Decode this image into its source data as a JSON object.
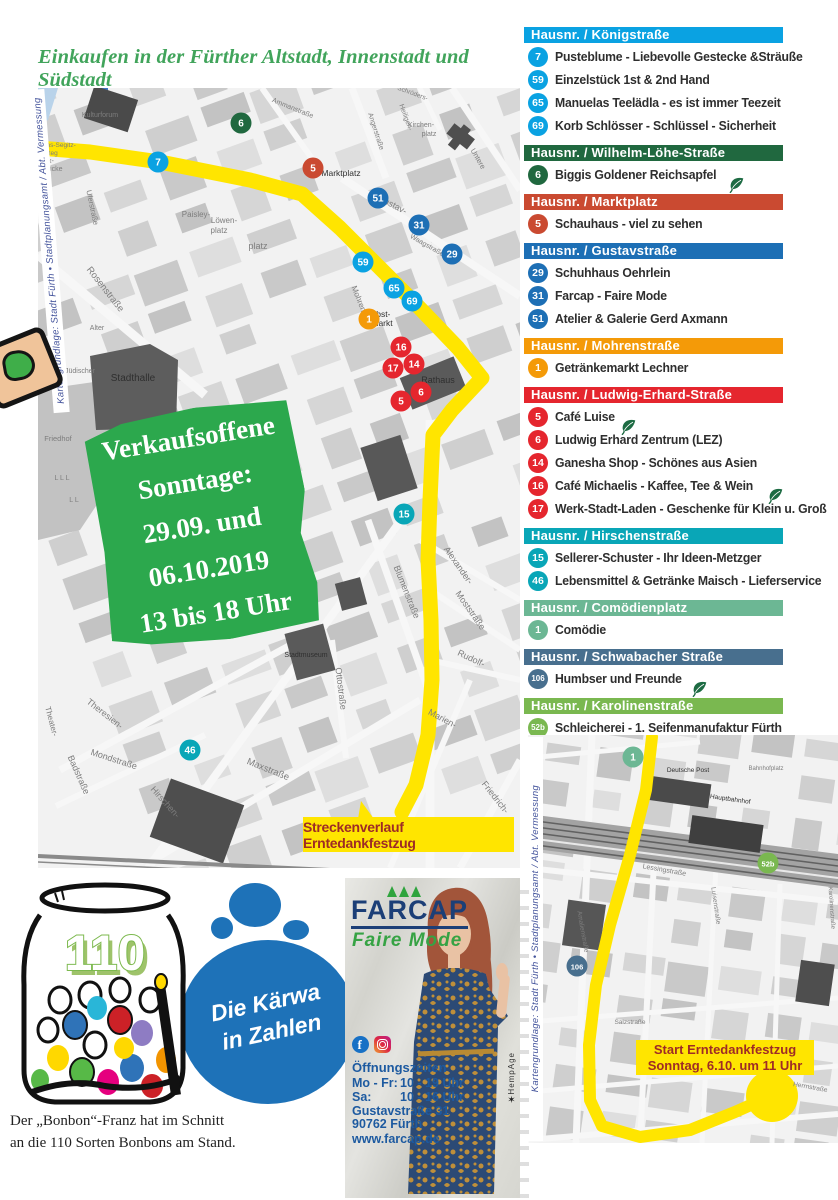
{
  "page": {
    "title": "Einkaufen in der Fürther Altstadt, Innenstadt und Südstadt"
  },
  "colors": {
    "title_green": "#41a45b",
    "promo_green": "#2ca84d",
    "route_yellow": "#ffe500",
    "route_label_red": "#9e2b26",
    "farcap_navy": "#1c3f77",
    "farcap_green": "#36a344",
    "farcap_blue": "#1d5aa0",
    "blob_blue": "#1e72b8",
    "leaf_green": "#1d6b43"
  },
  "sidebar": {
    "sections": [
      {
        "header": "Hausnr. / Königstraße",
        "color": "#0aa2e2",
        "items": [
          {
            "num": "7",
            "label": "Pusteblume - Liebevolle Gestecke &Sträuße",
            "leaf": false
          },
          {
            "num": "59",
            "label": "Einzelstück 1st & 2nd Hand",
            "leaf": false
          },
          {
            "num": "65",
            "label": "Manuelas Teelädla - es ist immer Teezeit",
            "leaf": false
          },
          {
            "num": "69",
            "label": "Korb Schlösser - Schlüssel - Sicherheit",
            "leaf": false
          }
        ]
      },
      {
        "header": "Hausnr. / Wilhelm-Löhe-Straße",
        "color": "#20683f",
        "items": [
          {
            "num": "6",
            "label": "Biggis Goldener Reichsapfel",
            "leaf": true
          }
        ]
      },
      {
        "header": "Hausnr. / Marktplatz",
        "color": "#ca4a31",
        "items": [
          {
            "num": "5",
            "label": "Schauhaus - viel zu sehen",
            "leaf": false
          }
        ]
      },
      {
        "header": "Hausnr. / Gustavstraße",
        "color": "#1d6fb5",
        "items": [
          {
            "num": "29",
            "label": "Schuhhaus Oehrlein",
            "leaf": false
          },
          {
            "num": "31",
            "label": "Farcap - Faire Mode",
            "leaf": false
          },
          {
            "num": "51",
            "label": "Atelier & Galerie Gerd Axmann",
            "leaf": false
          }
        ]
      },
      {
        "header": "Hausnr. / Mohrenstraße",
        "color": "#f49a08",
        "items": [
          {
            "num": "1",
            "label": "Getränkemarkt Lechner",
            "leaf": false
          }
        ]
      },
      {
        "header": "Hausnr. / Ludwig-Erhard-Straße",
        "color": "#e5262e",
        "items": [
          {
            "num": "5",
            "label": "Café Luise",
            "leaf": true
          },
          {
            "num": "6",
            "label": "Ludwig Erhard Zentrum (LEZ)",
            "leaf": false
          },
          {
            "num": "14",
            "label": "Ganesha Shop - Schönes aus Asien",
            "leaf": false
          },
          {
            "num": "16",
            "label": "Café Michaelis - Kaffee, Tee & Wein",
            "leaf": true
          },
          {
            "num": "17",
            "label": "Werk-Stadt-Laden - Geschenke für Klein u. Groß",
            "leaf": false
          }
        ]
      },
      {
        "header": "Hausnr. / Hirschenstraße",
        "color": "#09a6b7",
        "items": [
          {
            "num": "15",
            "label": "Sellerer-Schuster - Ihr Ideen-Metzger",
            "leaf": false
          },
          {
            "num": "46",
            "label": "Lebensmittel & Getränke Maisch - Lieferservice",
            "leaf": false
          }
        ]
      },
      {
        "header": "Hausnr. / Comödienplatz",
        "color": "#6cb794",
        "items": [
          {
            "num": "1",
            "label": "Comödie",
            "leaf": false
          }
        ]
      },
      {
        "header": "Hausnr. / Schwabacher Straße",
        "color": "#486f8e",
        "items": [
          {
            "num": "106",
            "label": "Humbser und Freunde",
            "leaf": true
          }
        ]
      },
      {
        "header": "Hausnr. / Karolinenstraße",
        "color": "#7ab850",
        "items": [
          {
            "num": "52b",
            "label": "Schleicherei - 1. Seifenmanufaktur Fürth",
            "leaf": false
          }
        ]
      }
    ]
  },
  "map_main": {
    "credit": "Kartengrundlage: Stadt Fürth • Stadtplanungsamt / Abt. Vermessung",
    "promo_lines": [
      "Verkaufsoffene",
      "Sonntage:",
      "29.09. und",
      "06.10.2019",
      "13 bis 18 Uhr"
    ],
    "route_label": "Streckenverlauf Erntedankfestzug",
    "markers": [
      {
        "n": "7",
        "x": 158,
        "y": 162,
        "c": "#0aa2e2"
      },
      {
        "n": "59",
        "x": 363,
        "y": 262,
        "c": "#0aa2e2"
      },
      {
        "n": "65",
        "x": 394,
        "y": 288,
        "c": "#0aa2e2"
      },
      {
        "n": "69",
        "x": 412,
        "y": 301,
        "c": "#0aa2e2"
      },
      {
        "n": "6",
        "x": 241,
        "y": 123,
        "c": "#20683f"
      },
      {
        "n": "5",
        "x": 313,
        "y": 168,
        "c": "#ca4a31"
      },
      {
        "n": "51",
        "x": 378,
        "y": 198,
        "c": "#1d6fb5"
      },
      {
        "n": "31",
        "x": 419,
        "y": 225,
        "c": "#1d6fb5"
      },
      {
        "n": "29",
        "x": 452,
        "y": 254,
        "c": "#1d6fb5"
      },
      {
        "n": "1",
        "x": 369,
        "y": 319,
        "c": "#f49a08"
      },
      {
        "n": "16",
        "x": 401,
        "y": 347,
        "c": "#e5262e"
      },
      {
        "n": "14",
        "x": 414,
        "y": 364,
        "c": "#e5262e"
      },
      {
        "n": "17",
        "x": 393,
        "y": 368,
        "c": "#e5262e"
      },
      {
        "n": "6",
        "x": 421,
        "y": 392,
        "c": "#e5262e"
      },
      {
        "n": "5",
        "x": 401,
        "y": 401,
        "c": "#e5262e"
      },
      {
        "n": "15",
        "x": 404,
        "y": 514,
        "c": "#09a6b7"
      },
      {
        "n": "46",
        "x": 190,
        "y": 750,
        "c": "#09a6b7"
      }
    ],
    "streets": [
      [
        "Kulturforum",
        100,
        117,
        0,
        7,
        0
      ],
      [
        "Hans-Segitz-",
        57,
        147,
        0,
        6.5,
        0
      ],
      [
        "Steg",
        51,
        155,
        0,
        6.5,
        0
      ],
      [
        "Max-",
        46,
        163,
        0,
        7,
        0
      ],
      [
        "brücke",
        52,
        171,
        0,
        7,
        0
      ],
      [
        "Uferstraße",
        90,
        208,
        78,
        7.5,
        0
      ],
      [
        "Ammanstraße",
        292,
        110,
        22,
        7,
        0
      ],
      [
        "Angerstraße",
        374,
        132,
        72,
        7,
        0
      ],
      [
        "Heiligen-",
        404,
        118,
        70,
        7,
        0
      ],
      [
        "Kirchen-",
        421,
        127,
        0,
        7,
        0
      ],
      [
        "platz",
        429,
        136,
        0,
        7,
        0
      ],
      [
        "Untere",
        476,
        160,
        60,
        7.5,
        0
      ],
      [
        "Schröders-",
        412,
        95,
        20,
        6.5,
        0
      ],
      [
        "Stadthalle",
        133,
        381,
        0,
        10,
        1
      ],
      [
        "Paisley-",
        196,
        217,
        0,
        8,
        0
      ],
      [
        "Löwen-",
        224,
        223,
        0,
        8,
        0
      ],
      [
        "platz",
        219,
        233,
        0,
        8,
        0
      ],
      [
        "platz",
        258,
        249,
        0,
        9,
        0
      ],
      [
        "Rosenstraße",
        103,
        291,
        52,
        9.5,
        0
      ],
      [
        "Marktplatz",
        341,
        176,
        0,
        8.5,
        1
      ],
      [
        "Gustav-",
        391,
        207,
        28,
        9,
        0
      ],
      [
        "Waagstraße",
        426,
        247,
        30,
        7,
        0
      ],
      [
        "Mohren-",
        357,
        301,
        68,
        8,
        0
      ],
      [
        "Obst-",
        380,
        317,
        0,
        8.5,
        1
      ],
      [
        "markt",
        382,
        326,
        0,
        8.5,
        1
      ],
      [
        "Rathaus",
        438,
        383,
        0,
        9,
        1
      ],
      [
        "Alter",
        97,
        330,
        0,
        7,
        0
      ],
      [
        "Jüdischer",
        80,
        373,
        0,
        7,
        0
      ],
      [
        "Friedhof",
        58,
        441,
        0,
        7.5,
        0
      ],
      [
        "L  L  L",
        62,
        480,
        0,
        7,
        0
      ],
      [
        "L  L",
        74,
        502,
        0,
        7,
        0
      ],
      [
        "Blumenstraße",
        404,
        593,
        68,
        9,
        0
      ],
      [
        "Alexander-",
        456,
        567,
        55,
        9,
        0
      ],
      [
        "Moststraße",
        468,
        612,
        55,
        9,
        0
      ],
      [
        "Rudolf-",
        470,
        661,
        25,
        9,
        0
      ],
      [
        "Ottostraße",
        338,
        689,
        83,
        9,
        0
      ],
      [
        "Stadtmuseum",
        306,
        657,
        0,
        7,
        1
      ],
      [
        "Hirschen-",
        299,
        586,
        58,
        9,
        0
      ],
      [
        "Marien-",
        441,
        721,
        28,
        9,
        0
      ],
      [
        "Maxstraße",
        267,
        772,
        22,
        9.5,
        0
      ],
      [
        "Mondstraße",
        113,
        762,
        18,
        9,
        0
      ],
      [
        "Theresien-",
        103,
        716,
        38,
        9,
        0
      ],
      [
        "Badstraße",
        76,
        776,
        66,
        9,
        0
      ],
      [
        "Theater-",
        49,
        722,
        75,
        8,
        0
      ],
      [
        "Hirschen-",
        163,
        804,
        48,
        9,
        0
      ],
      [
        "Friedrich-",
        493,
        799,
        52,
        9,
        0
      ]
    ]
  },
  "map_station": {
    "credit": "Kartengrundlage: Stadt Fürth • Stadtplanungsamt / Abt. Vermessung",
    "start_label_line1": "Start Erntedankfestzug",
    "start_label_line2": "Sonntag, 6.10. um 11 Uhr",
    "markers": [
      {
        "n": "1",
        "x": 633,
        "y": 757,
        "c": "#6cb794"
      },
      {
        "n": "52b",
        "x": 768,
        "y": 863,
        "c": "#7ab850"
      },
      {
        "n": "106",
        "x": 577,
        "y": 966,
        "c": "#486f8e"
      }
    ],
    "streets": [
      [
        "Deutsche Post",
        688,
        772,
        0,
        6.5,
        1
      ],
      [
        "Bahnhofplatz",
        766,
        770,
        0,
        6,
        0
      ],
      [
        "Hauptbahnhof",
        730,
        801,
        8,
        6.5,
        1
      ],
      [
        "Lessingstraße",
        664,
        872,
        10,
        7,
        0
      ],
      [
        "Amalienstraße",
        581,
        932,
        80,
        6.5,
        0
      ],
      [
        "Luisenstraße",
        714,
        906,
        82,
        6.5,
        0
      ],
      [
        "Salzstraße",
        630,
        1024,
        0,
        6.5,
        0
      ],
      [
        "Herrnstraße",
        810,
        1089,
        10,
        6.5,
        0
      ],
      [
        "Karolinenstraße",
        830,
        908,
        86,
        6,
        0
      ]
    ]
  },
  "kaerwa": {
    "number": "110",
    "blob_line1": "Die Kärwa",
    "blob_line2": "in Zahlen",
    "caption_line1": "Der „Bonbon“-Franz hat im Schnitt",
    "caption_line2": "an die 110 Sorten Bonbons am Stand."
  },
  "farcap": {
    "logo": "FARCAP",
    "tagline": "Faire Mode",
    "hours_title": "Öffnungszeiten",
    "hours": [
      {
        "days": "Mo - Fr:",
        "time": "10 - 19 Uhr"
      },
      {
        "days": "Sa:",
        "time": "10 - 16 Uhr"
      }
    ],
    "address1": "Gustavstraße 31",
    "address2": "90762 Fürth",
    "website": "www.farcap.de",
    "vertical_brand": "HempAge"
  }
}
